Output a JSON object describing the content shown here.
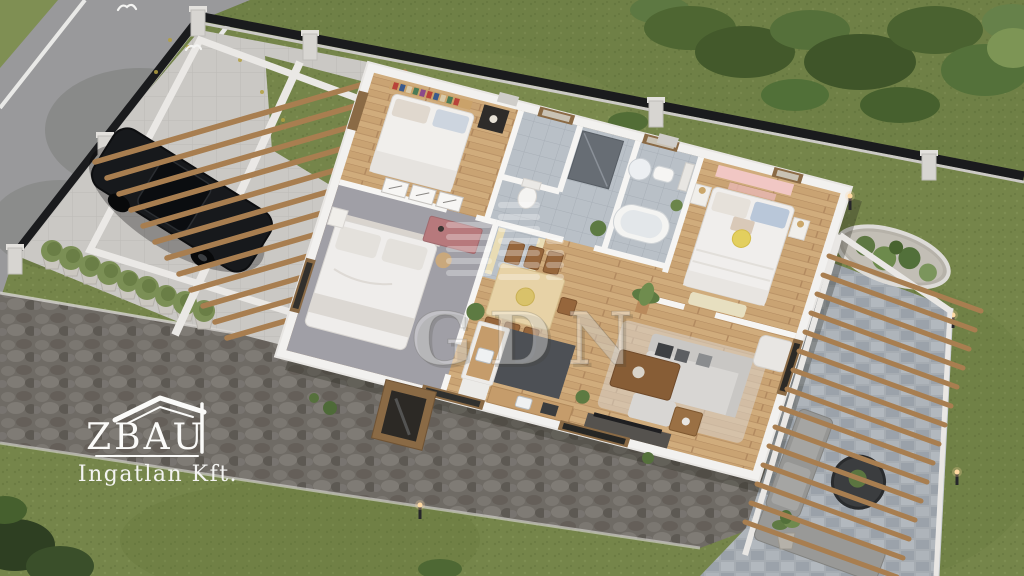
{
  "watermark": {
    "text": "GDN",
    "icon": "city-skyline-bars-icon"
  },
  "logo": {
    "brand": "ZBAU",
    "subtitle": "Ingatlan Kft.",
    "icon": "house-roof-icon"
  },
  "palette": {
    "lawn": "#75854A",
    "neighbor_grass_shade": "#4E6632",
    "road_asphalt": "#99999B",
    "road_marking": "#E9E9E7",
    "cobblestone": "#6F6B65",
    "patio_stone": "#A6ACB2",
    "concrete_paving": "#CAC8C4",
    "house_wall": "#F2F1EF",
    "wood_floor": "#D0AC7C",
    "pergola_wood": "#A87E50",
    "fence_black": "#1A1B1D",
    "car_black": "#17191C",
    "accent_pink": "#F1C7C4",
    "bath_tile": "#B9C0C7",
    "carpet_gray": "#A09FA6",
    "watermark_white": "rgba(255,255,255,0.36)"
  }
}
